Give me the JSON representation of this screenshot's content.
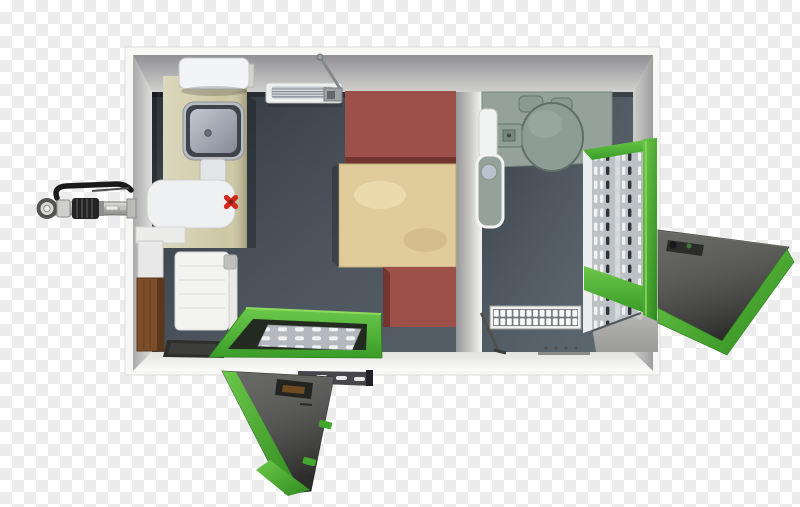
{
  "meta": {
    "title": "Portable container unit - top view 3D render on transparency checkerboard"
  },
  "background": {
    "checker_light": "#ffffff",
    "checker_dark": "#ececec",
    "square_px": 12
  },
  "colors": {
    "container_shell": "#f7f7f5",
    "wall_gray": "#c6c6c4",
    "floor_left": "#3b4650",
    "floor_right": "#46525c",
    "counter_khaki": "#cdc7a2",
    "bench_red": "#9d4f4a",
    "table_tan": "#e0cb9b",
    "fixture_sage": "#95a29b",
    "door_green_light": "#6cc84a",
    "door_green_dark": "#2f8a1e",
    "door_panel_gray": "#474844",
    "metal_light": "#bcc1c5",
    "hitch_black": "#1b1b1b"
  },
  "objects": {
    "left_room": [
      "refrigerator",
      "kitchen-counter",
      "kitchen-sink",
      "soap-dispenser",
      "red-valve",
      "water-heater",
      "wall-shelf",
      "storage-box",
      "wooden-board",
      "wall-radiator",
      "floor-mat",
      "ceiling-radiator",
      "window-stay-arm",
      "bench-seat-top",
      "folding-table",
      "bench-seat-bottom",
      "entry-door-open",
      "door-grate-ramp",
      "mounting-bracket"
    ],
    "right_room": [
      "toilet-platform",
      "toilet-lid",
      "cistern-caps",
      "access-panel",
      "wall-cabinet",
      "urinal",
      "floor-vent",
      "threshold-strip",
      "floor-squeegee",
      "privacy-screen",
      "side-door-open",
      "side-door-ramp"
    ],
    "exterior": [
      "tow-hitch"
    ]
  }
}
